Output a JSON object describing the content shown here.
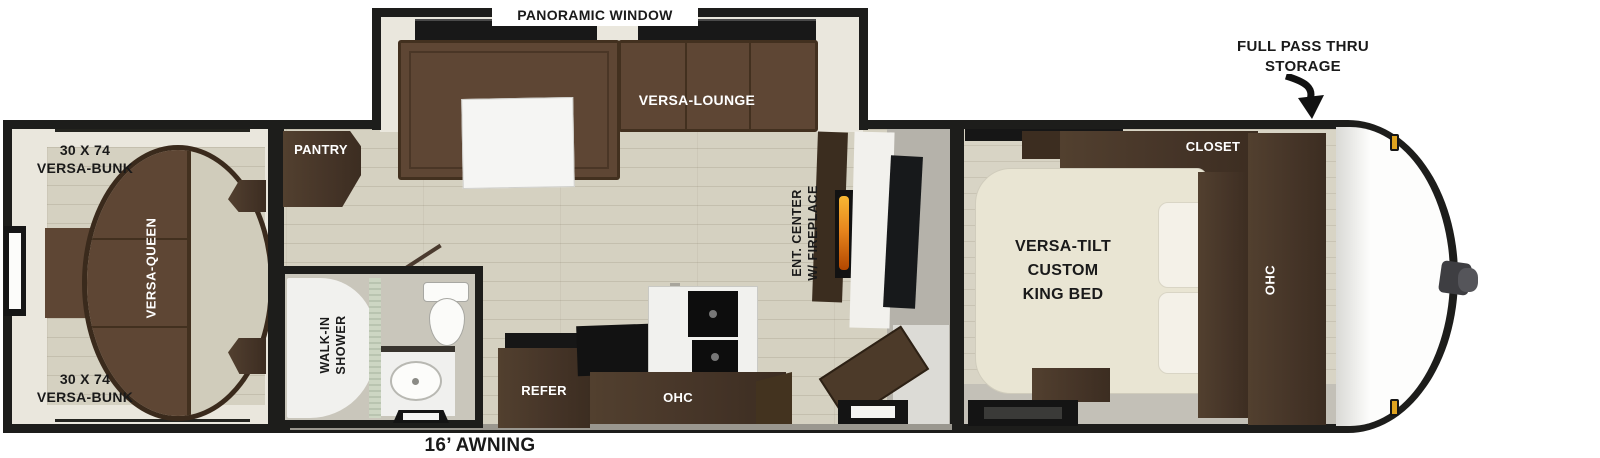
{
  "type": "travel-trailer-floorplan",
  "colors": {
    "wall": "#1d1d1b",
    "floor_wood": "#d5d1c1",
    "interior_cream": "#eae7dd",
    "sofa_brown": "#5e4634",
    "cabinet_dark_brown": "#47362a",
    "bed_cream": "#e9e5d3",
    "flame_orange": "#e8871e",
    "marker_light_amber": "#dfa31f"
  },
  "labels": {
    "panoramic_window": "PANORAMIC WINDOW",
    "full_pass_thru_storage": "FULL PASS THRU\nSTORAGE",
    "versa_lounge": "VERSA-LOUNGE",
    "bunk_top": "30 X 74\nVERSA-BUNK",
    "versa_queen": "VERSA-QUEEN",
    "bunk_bottom": "30 X 74\nVERSA-BUNK",
    "pantry": "PANTRY",
    "ent_center": "ENT. CENTER\nW/ FIREPLACE",
    "walk_in_shower": "WALK-IN\nSHOWER",
    "refer": "REFER",
    "ohc_kitchen": "OHC",
    "closet": "CLOSET",
    "king_bed": "VERSA-TILT\nCUSTOM\nKING BED",
    "ohc_bedroom": "OHC",
    "awning": "16’ AWNING"
  }
}
